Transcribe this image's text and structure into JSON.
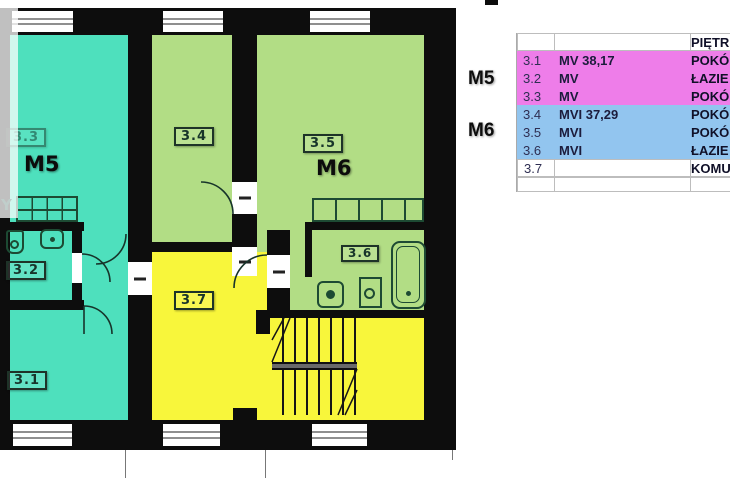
{
  "plan": {
    "watermark_text": "Y",
    "apartments": {
      "m5_label": "M5",
      "m6_label": "M6"
    },
    "room_labels": {
      "r31": "3.1",
      "r32": "3.2",
      "r33": "3.3",
      "r34": "3.4",
      "r35": "3.5",
      "r36": "3.6",
      "r37": "3.7"
    },
    "colors": {
      "m5_fill": "#4ee0bd",
      "m6_fill": "#b2dd85",
      "corridor_fill": "#f8f63b",
      "wall": "#0d0d0d"
    }
  },
  "legend": {
    "header": {
      "col3": "PIĘTR"
    },
    "rows": [
      {
        "no": "3.1",
        "unit": "MV 38,17",
        "name": "POKÓ",
        "group": "M5"
      },
      {
        "no": "3.2",
        "unit": "MV",
        "name": "ŁAZIE",
        "group": "M5"
      },
      {
        "no": "3.3",
        "unit": "MV",
        "name": "POKÓ",
        "group": "M5"
      },
      {
        "no": "3.4",
        "unit": "MVI 37,29",
        "name": "POKÓ",
        "group": "M6"
      },
      {
        "no": "3.5",
        "unit": "MVI",
        "name": "POKÓ",
        "group": "M6"
      },
      {
        "no": "3.6",
        "unit": "MVI",
        "name": "ŁAZIE",
        "group": "M6"
      },
      {
        "no": "3.7",
        "unit": "",
        "name": "KOMU",
        "group": ""
      }
    ],
    "group_labels": {
      "m5": "M5",
      "m6": "M6"
    },
    "colors": {
      "m5_row": "#ee7de9",
      "m6_row": "#92c5ef"
    }
  }
}
